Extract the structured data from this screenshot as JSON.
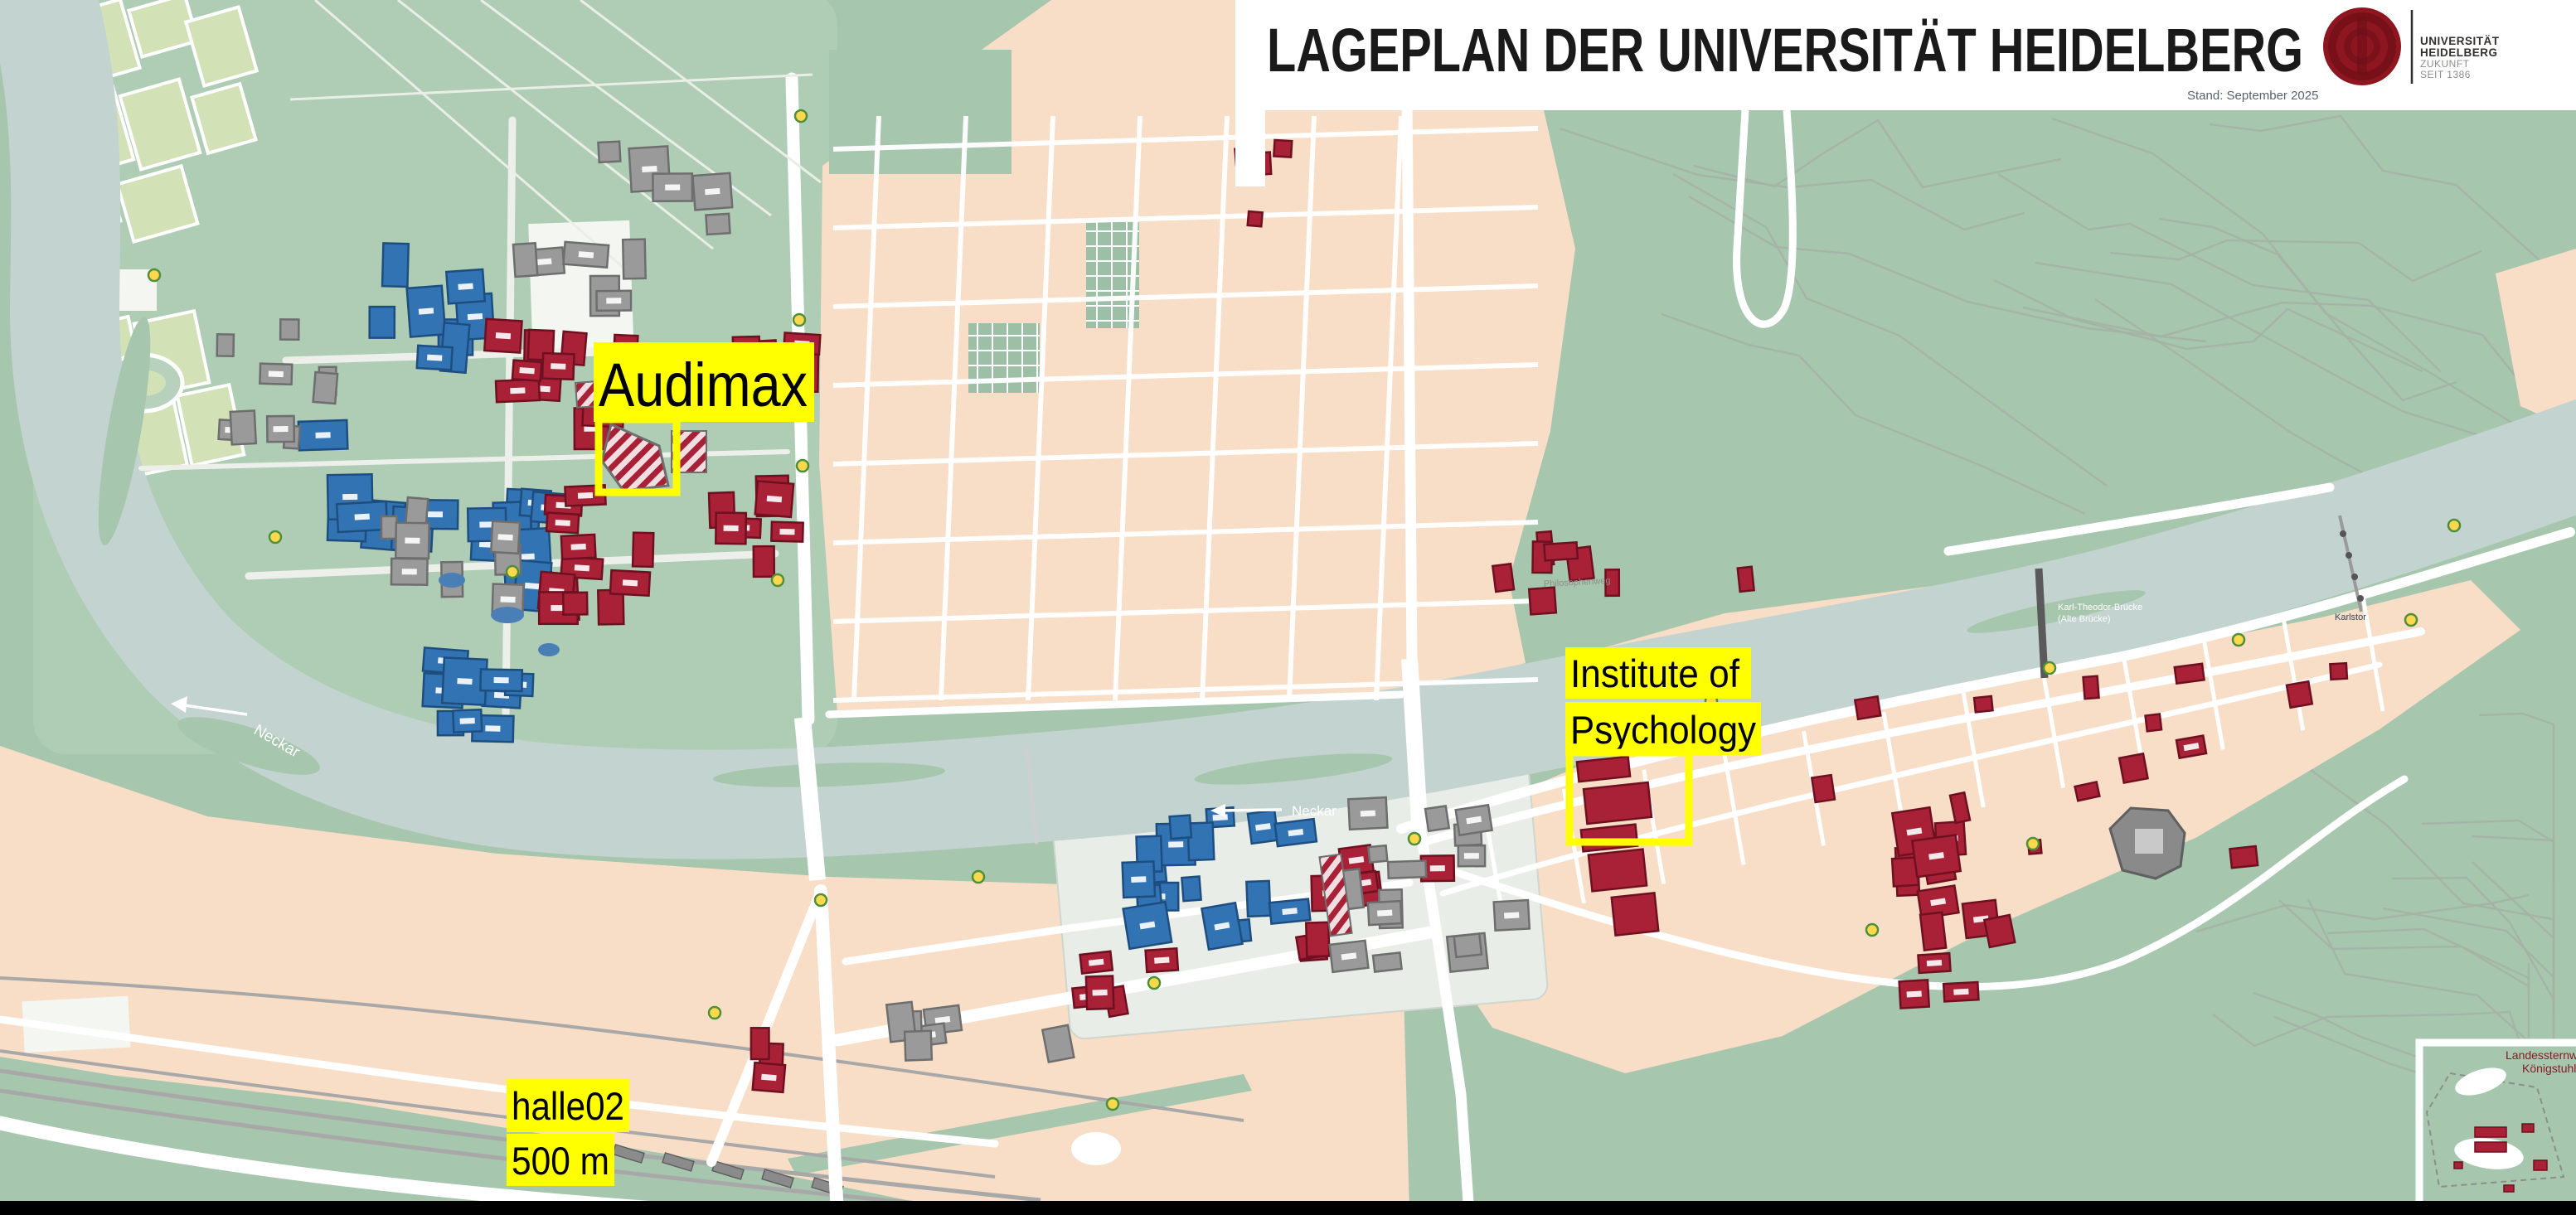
{
  "header": {
    "title": "LAGEPLAN DER UNIVERSITÄT HEIDELBERG",
    "stand": "Stand: September 2025",
    "logo": {
      "institution_line1": "UNIVERSITÄT",
      "institution_line2": "HEIDELBERG",
      "claim_line1": "ZUKUNFT",
      "claim_line2": "SEIT 1386"
    }
  },
  "annotations": {
    "audimax": {
      "label": "Audimax"
    },
    "institute": {
      "line1": "Institute of",
      "line2": "Psychology"
    },
    "halle02": {
      "line1": "halle02",
      "line2": "500 m"
    }
  },
  "map_labels": {
    "neckar_west": "Neckar",
    "neckar_mid": "Neckar",
    "philosophenweg": "Philosophenweg",
    "karlstor": "Karlstor",
    "alte_bruecke_line1": "Karl-Theodor-Brücke",
    "alte_bruecke_line2": "(Alte Brücke)",
    "observatory_line1": "Landessternwarte",
    "observatory_line2": "Königstuhl"
  },
  "palette": {
    "land_green": "#a7c6ae",
    "campus_green": "#b7d1bc",
    "river_blue": "#c2d3d0",
    "urban_peach": "#f8ddc7",
    "sports_field_green": "#d3e1b7",
    "university_red": "#a82136",
    "university_red_dark": "#6f1020",
    "clinic_blue": "#3273b4",
    "clinic_blue_dark": "#1d4e7f",
    "building_gray": "#9a9a9a",
    "building_gray_dark": "#6e6e6e",
    "road_white": "#ffffff",
    "path_gray": "#a4b2a6",
    "highlight_yellow": "#ffff00",
    "logo_seal_red": "#8e1620",
    "header_white": "#ffffff",
    "footer_black": "#000000",
    "bus_stop_yellow": "#ffd84d",
    "bus_stop_green": "#4e8f3a"
  }
}
